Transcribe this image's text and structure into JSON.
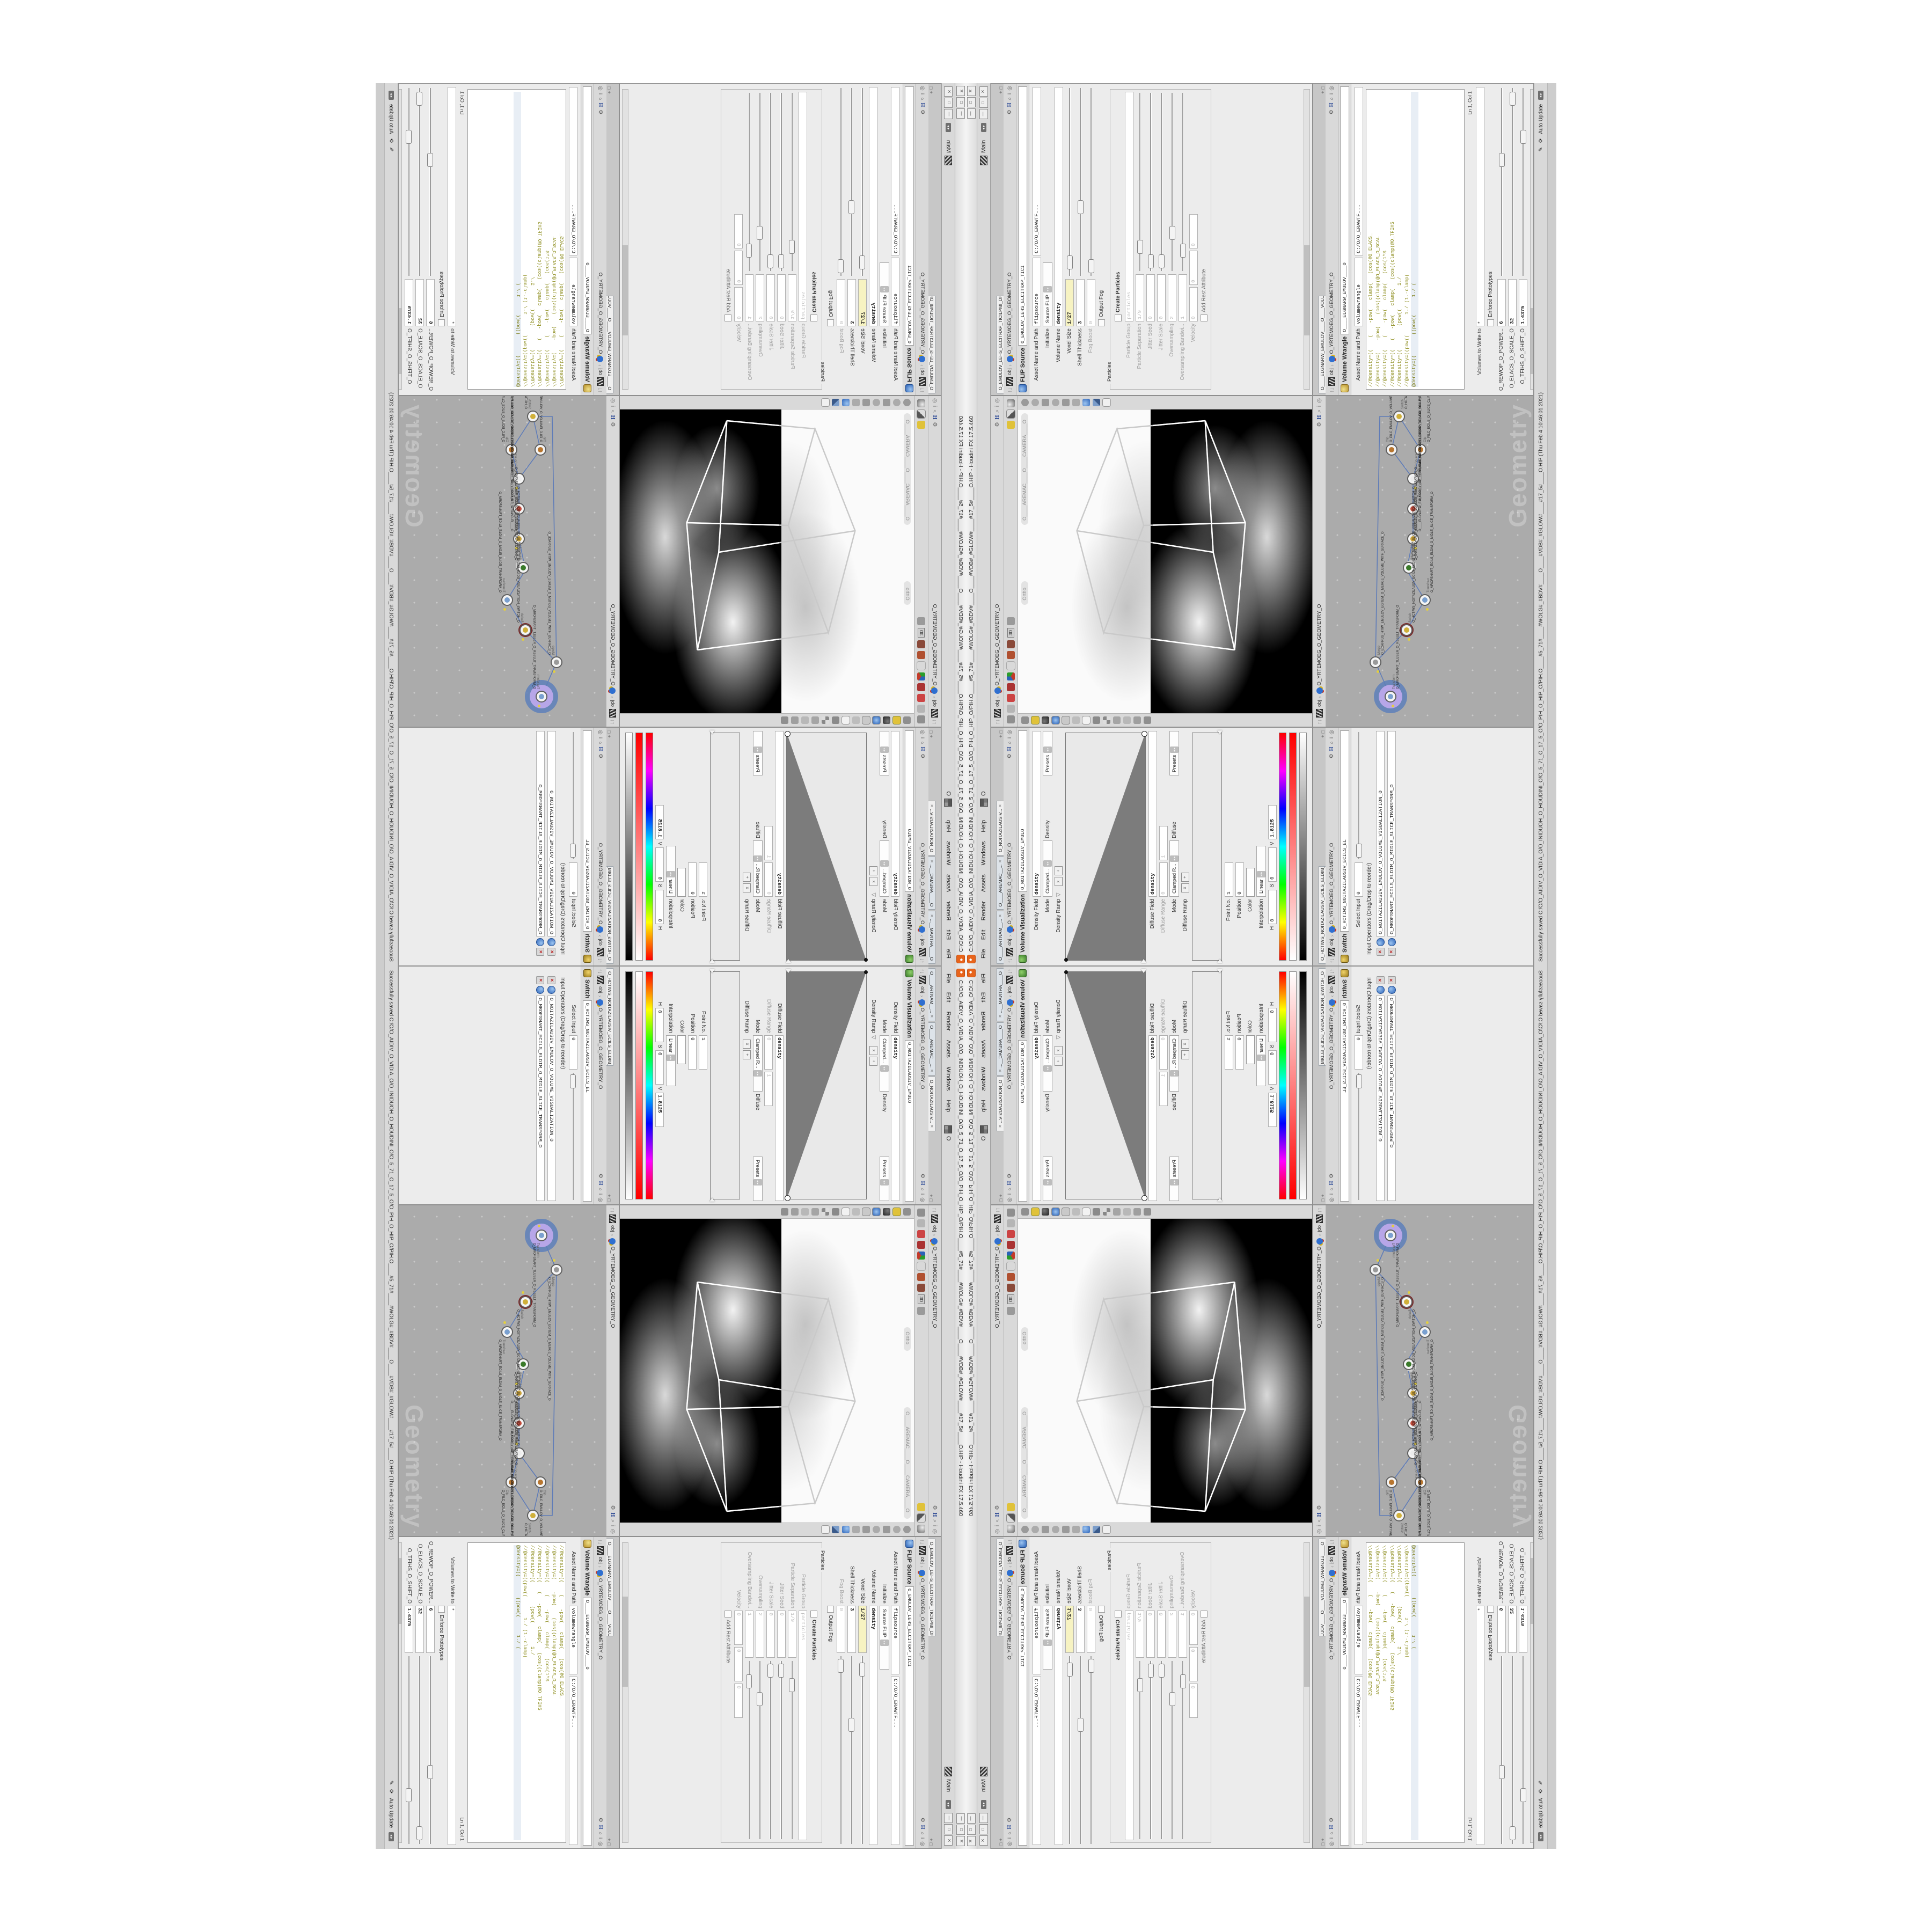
{
  "window": {
    "title": "C:/O/O_AIDIV_O_VIDIA_O/O_INIDUOH_O_HOUDINI_O/O_5_71_O_17_5_O/O_PIH_O_HIP_O/PIH.O____#5_71#____#WOLG#_#BDV#____O____#VDB#_#GLOW#____#17_5#____O.HIP - Houdini FX 17.5.460"
  },
  "icons": {
    "close": "✕",
    "min": "—",
    "max": "□",
    "gear": "⚙",
    "search": "⌕",
    "info": "i",
    "target": "◎",
    "up": "↑",
    "down": "↓",
    "chev": "›",
    "spin": "◂ ▸",
    "drop": "▾",
    "pencil": "✎",
    "refresh": "⟳",
    "plus": "+",
    "del": "x",
    "tri": "▽",
    "scroll": "◂ ▸",
    "h": "H"
  },
  "menu": {
    "file": "File",
    "edit": "Edit",
    "render": "Render",
    "assets": "Assets",
    "windows": "Windows",
    "help": "Help",
    "grid_o": "O",
    "desktop": "Main"
  },
  "crumb": {
    "ctx": "obj",
    "geo": "O_YRTEMOEG_O_GEOMETRY_O"
  },
  "volviz": {
    "tabs": [
      "O____ARTNAM__...",
      "O____AREMAC__...",
      "O_NOITAZILAUSIV..."
    ],
    "name": "Volume Visualization",
    "inst": "O_NOITAZILAUSIV_EMULO",
    "density_field_l": "Density Field",
    "density_field": "density",
    "mode_l": "Mode",
    "mode": "Clamped...",
    "density_tag": "Density",
    "presets": "Presets",
    "density_ramp_l": "Density Ramp",
    "diffuse_field_l": "Diffuse Field",
    "diffuse_field": "density",
    "diffuse_range_l": "Diffuse Range",
    "dr0": "0",
    "dr1": "1",
    "mode2": "Clamped R...",
    "diffuse_tag": "Diffuse",
    "diffuse_ramp_l": "Diffuse Ramp",
    "point_l": "Point No.",
    "point": "1",
    "pos_l": "Position",
    "pos": "0",
    "color_l": "Color",
    "interp_l": "Interpolation",
    "interp": "Linear",
    "h_l": "H",
    "h": "0",
    "s_l": "S",
    "s": "0",
    "v_l": "V",
    "v": "1.8125"
  },
  "sw": {
    "tab": "O_HCTIWS_NOITAZILAUSIV_ECILS_ELDIM_O_MIDLE_SLICE_VISUAL...",
    "name": "Switch",
    "inst": "O_HCTIWS_NOITAZILAUSIV_ECILS_EL",
    "select_l": "Select Input",
    "select": "0",
    "ops_l": "Input Operators (Drag/Drop to reorder)",
    "ops": [
      "O_NOITAZILAUSIV_EMULOV_O_VOLUME_VISUALIZATION_O",
      "O_MROFSNART_ECILS_ELDIM_O_MIDLE_SLICE_TRANSFORM_O"
    ]
  },
  "view": {
    "ortho": "Ortho",
    "camera": "O____AREMAC____O____CAMERA____O",
    "threed": "3D"
  },
  "net": {
    "watermark": "Geometry",
    "nodes": [
      {
        "t": "Transform",
        "n": "O_MROFSNART_TLUSER_O_RESULT_TRANSFORM_O"
      },
      {
        "t": "Merge",
        "n": "O_ECAFRUS_HTIW_EMULOV_EGREM_O_MERGE_VOLUME_WITH_SURFACE_O"
      },
      {
        "t": "Switch",
        "n": "O_HCTIWS_NOITAZILAUSV_ECILS_ELDIM_O_MIDLE_SLICE_VISUALIZATION_SWITCH_O"
      },
      {
        "t": "Transform",
        "n": "O_MROFSNART_ECILS_ELDIM_O_MIDLE_SLICE_TRANSFORM_O"
      },
      {
        "t": "Volume Slice",
        "n": "O_NOITAZILAUSIV_EMULOV_O_VOLUME_VISUALIZATION_O"
      },
      {
        "t": "Volume Wrangle",
        "n": "O____ELGNARW_EMULOV____O____VOLUME_WRANGLE____O2"
      },
      {
        "t": "VDB from Polygons",
        "n": "O_SNOGYLOP_YRTEMOEG_MORF_EMULOV_BDV_O_VDB_VOLUME_FROM_GEOMETRY_POLYGONS_O"
      },
      {
        "t": "FLIP Source",
        "n": "O_EMULOV_LEHS_ELCITRAP_TICILPMI_DIULF_O_FLUID_IMPLICIT_PARTICLE_SHEL_VOLUME_O"
      },
      {
        "t": "Clip",
        "n": "O_PILC_EMULOV_O_VOLUME_CLIP_O"
      },
      {
        "t": "Clip",
        "n": "O_PILC_ECILS_O_SLICE_CLIP_O"
      },
      {
        "t": "Switch",
        "n": "O_HCTIWS_YRTEMOEG_LANRETNI_LANRETXE_O_INTERNAL_EXTERNAL_GEOMETRY_SWITCH_O"
      }
    ]
  },
  "flip": {
    "tab": "O_EMULOV_LEHS_ELCITRAP_TICILPMI_DIULF_O_FLUID_IMPLICIT_PARTI...",
    "name": "FLIP Source",
    "inst": "O_EMULOV_LEHS_ELCITRAP_TICI",
    "asset_l": "Asset Name and Path",
    "asset": "flipsource",
    "path": "C:/O/O_ERAWTF...",
    "init_l": "Initialize",
    "init": "Source FLIP",
    "vol_l": "Volume Name",
    "vol": "density",
    "voxel_l": "Voxel Size",
    "voxel": "1/27",
    "shell_l": "Shell Thickness",
    "shell": "3",
    "fog_l": "Fog Boost",
    "fog": "0",
    "outfog_l": "Output Fog",
    "particles_l": "Particles",
    "create_l": "Create Particles",
    "pgroup_l": "Particle Group",
    "pgroup": "particles",
    "psep_l": "Particle Separation",
    "psep": "1/9",
    "jseed_l": "Jitter Seed",
    "jseed": "0",
    "jscale_l": "Jitter Scale",
    "jscale": "0",
    "over_l": "Oversampling",
    "over": "2",
    "overbw_l": "Oversampling Bandwi...",
    "overbw": "1",
    "vel_l": "Velocity",
    "vel0": "0",
    "vel1": "0",
    "vel2": "0",
    "rest_l": "Add Rest Attribute"
  },
  "wr": {
    "tab": "O____ELGNARW_EMULOV____O____VOLUME_WRANGL...",
    "name": "Volume Wrangle",
    "inst": "O____ELGNARW_EMULOV____O",
    "asset_l": "Asset Name and Path",
    "asset": "volumewrangle",
    "path": "C:/O/O_ERAWTF...",
    "code": [
      "//@density=((    (    -pow(   clamp(   (cos(@O_ELACS_",
      "//@density=(    -pow(    (cos((clamp(@O_ELACS_O_SCAL",
      "//@density=((    (    -pow(   clamp(   (cos(1*$",
      "//@density=((   (   -pow(   clamp(   (cos((clamp(@O_TFIHS",
      "//@density=((        (pow((        1./",
      "//@density=((pow((       1./ (1.-clamp(",
      "@density=((       ((pow((      1./ ("
    ],
    "lncol": "Ln 1, Col 1",
    "volumes_l": "Volumes to Write to",
    "volumes": "*",
    "enforce_l": "Enforce Prototypes",
    "sliders": [
      {
        "l": "O_REWOP_O_POWER...",
        "v": "6"
      },
      {
        "l": "O_ELACS_O_SCALE_O",
        "v": "32"
      },
      {
        "l": "O_TFIHS_O_SHIFT_O",
        "v": "1.4375"
      }
    ]
  },
  "status": {
    "msg": "Successfully saved C:/O/O_AIDIV_O_VIDIA_O/O_INIDUOH_O_HOUDINI_O/O_5_71_O_17_5_O/O_PIH_O_HIP_O/PIH.O____#5_71#____#WOLG#_#BDV#____O____#VDB#_#GLOW#____#17_5#____O.HIP (Thu Feb 4 10:46:01 2021)",
    "auto": "Auto Update"
  },
  "colors": {
    "houdini_orange": "#e8641b",
    "expr_yellow": "#f7f3c2",
    "vex_olive": "#8b8b1a",
    "wire_blue": "#5f7cb8",
    "select_purple": "#b7a6e8",
    "select_blue": "#5d7fba",
    "flag_yellow": "#e3cf3f",
    "network_bg": "#ababab",
    "viewport_black": "#000000"
  }
}
